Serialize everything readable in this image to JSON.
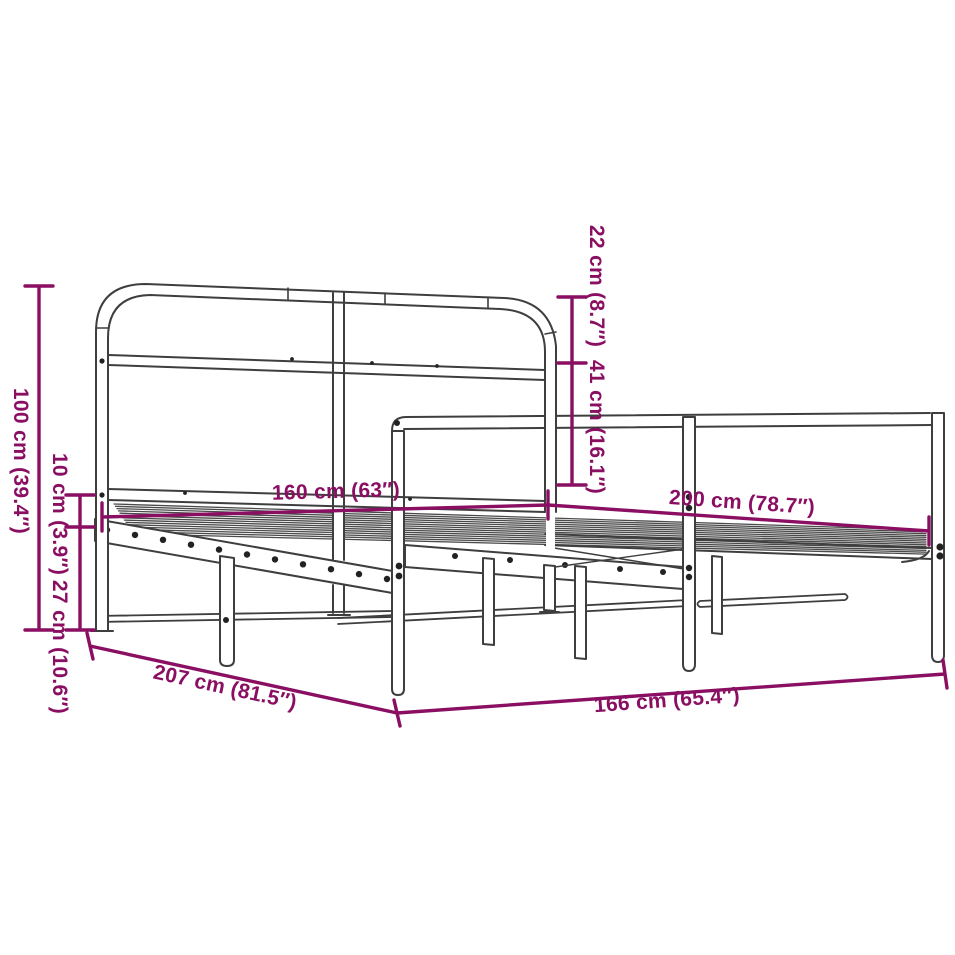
{
  "diagram": {
    "description": "Dimension diagram of a metal bed frame with arched headboard, slatted base, perforated side rails and support legs",
    "background_color": "#FFFFFF",
    "line_color": "#3E3E3E",
    "dimension_color": "#8A0F63",
    "dimensions": [
      {
        "id": "total-height",
        "label": "100 cm (39.4″)",
        "cm": 100,
        "inches": 39.4,
        "orientation": "vertical"
      },
      {
        "id": "base-profile-height",
        "label": "10 cm (3.9″)",
        "cm": 10,
        "inches": 3.9,
        "orientation": "vertical"
      },
      {
        "id": "ground-clearance",
        "label": "27 cm (10.6″)",
        "cm": 27,
        "inches": 10.6,
        "orientation": "vertical"
      },
      {
        "id": "headboard-upper-section",
        "label": "22 cm (8.7″)",
        "cm": 22,
        "inches": 8.7,
        "orientation": "vertical"
      },
      {
        "id": "headboard-lower-section",
        "label": "41 cm (16.1″)",
        "cm": 41,
        "inches": 16.1,
        "orientation": "vertical"
      },
      {
        "id": "bed-width",
        "label": "160 cm (63″)",
        "cm": 160,
        "inches": 63,
        "orientation": "horizontal"
      },
      {
        "id": "bed-length",
        "label": "200 cm (78.7″)",
        "cm": 200,
        "inches": 78.7,
        "orientation": "horizontal"
      },
      {
        "id": "frame-outer-length",
        "label": "207 cm (81.5″)",
        "cm": 207,
        "inches": 81.5,
        "orientation": "diagonal"
      },
      {
        "id": "frame-outer-width",
        "label": "166 cm (65.4″)",
        "cm": 166,
        "inches": 65.4,
        "orientation": "diagonal"
      }
    ]
  }
}
